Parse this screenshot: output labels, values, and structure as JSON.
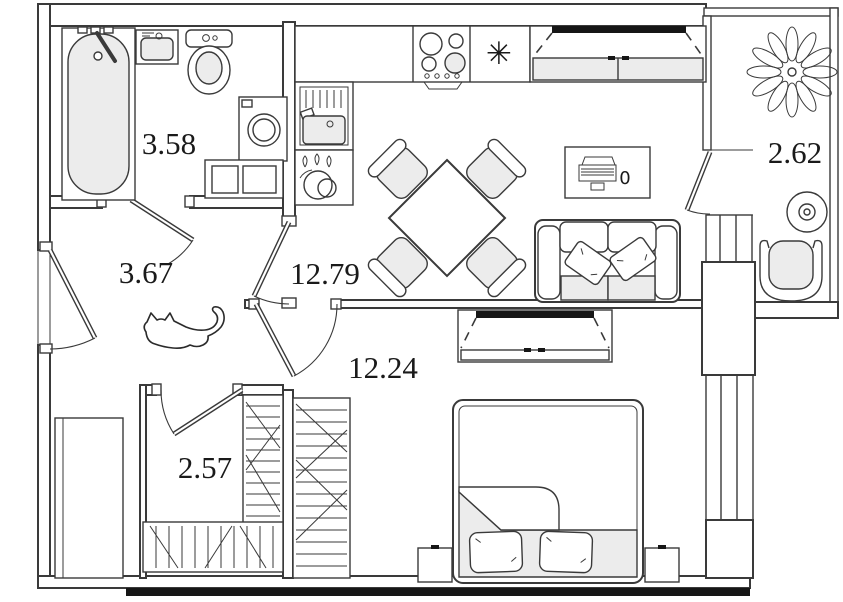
{
  "floor_plan": {
    "unit_labels": {
      "bathroom": "3.58",
      "hallway": "3.67",
      "kitchen_living": "12.79",
      "balcony": "2.62",
      "bedroom": "12.24",
      "closet": "2.57"
    },
    "areas_numeric": {
      "bathroom": 3.58,
      "hallway": 3.67,
      "kitchen_living": 12.79,
      "balcony": 2.62,
      "bedroom": 12.24,
      "closet": 2.57
    },
    "symbols": {
      "refrigerator_star": "✳",
      "desk_chair": "0"
    },
    "colors": {
      "wall_stroke": "#3a3a3a",
      "furniture_fill": "#ececec",
      "accent_black": "#161616",
      "background": "#ffffff"
    }
  }
}
